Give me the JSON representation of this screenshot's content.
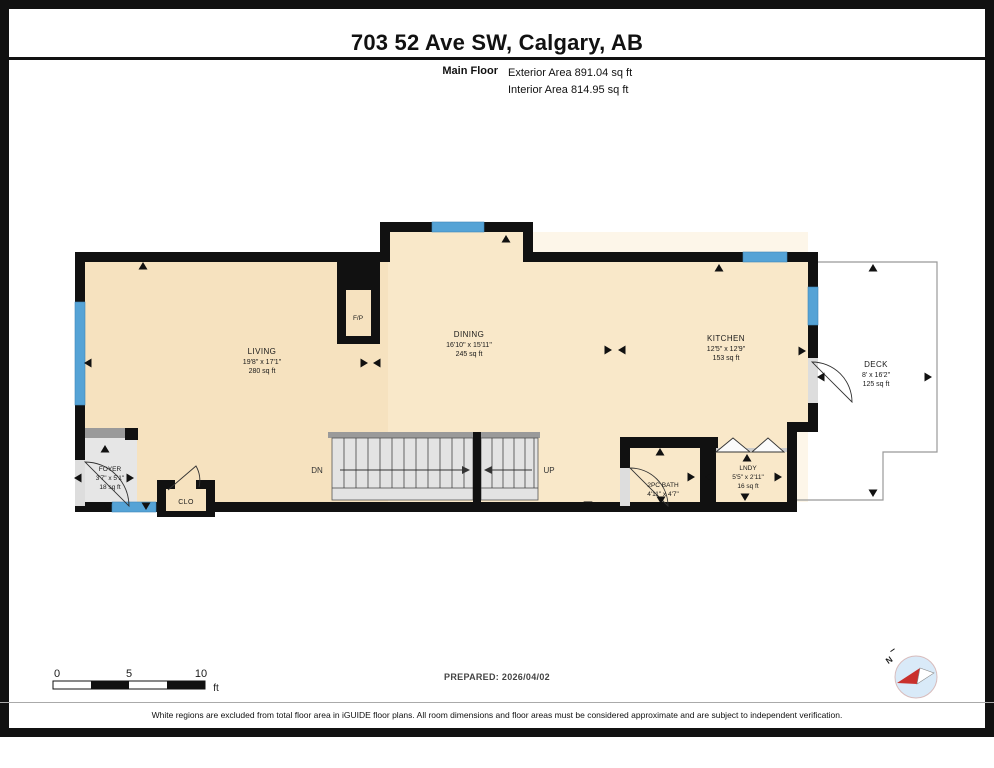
{
  "header": {
    "title": "703 52 Ave SW, Calgary, AB",
    "floor_label": "Main Floor",
    "exterior_area": "Exterior Area 891.04 sq ft",
    "interior_area": "Interior Area 814.95 sq ft"
  },
  "rooms": {
    "living": {
      "name": "LIVING",
      "dims": "19'8\" x 17'1\"",
      "area": "280 sq ft"
    },
    "dining": {
      "name": "DINING",
      "dims": "16'10\" x 15'11\"",
      "area": "245 sq ft"
    },
    "kitchen": {
      "name": "KITCHEN",
      "dims": "12'5\" x 12'9\"",
      "area": "153 sq ft"
    },
    "deck": {
      "name": "DECK",
      "dims": "8' x 16'2\"",
      "area": "125 sq ft"
    },
    "foyer": {
      "name": "FOYER",
      "dims": "3'7\" x 5'1\"",
      "area": "18 sq ft"
    },
    "bath": {
      "name": "2PC BATH",
      "dims": "4'11\" x 4'7\""
    },
    "laundry": {
      "name": "LNDY",
      "dims": "5'5\" x 2'11\"",
      "area": "16 sq ft"
    },
    "closet": {
      "name": "CLO"
    },
    "fireplace": {
      "name": "F/P"
    }
  },
  "stairs": {
    "down_label": "DN",
    "up_label": "UP"
  },
  "scale_bar": {
    "tick0": "0",
    "tick5": "5",
    "tick10": "10",
    "unit": "ft"
  },
  "compass": {
    "north_label": "N"
  },
  "footer": {
    "prepared": "PREPARED: 2026/04/02",
    "disclaimer": "White regions are excluded from total floor area in iGUIDE floor plans. All room dimensions and floor areas must be considered approximate and are subject to independent verification."
  },
  "colors": {
    "wall": "#111111",
    "floor": "#F6E2BF",
    "floor_light": "#FBEDD4",
    "window": "#55A3D6",
    "excluded_gray": "#E6E6E6",
    "stair_fill": "#E3E3E3",
    "deck_outline": "#999999",
    "compass_red": "#C9302C",
    "compass_blue": "#D9EAF8"
  }
}
